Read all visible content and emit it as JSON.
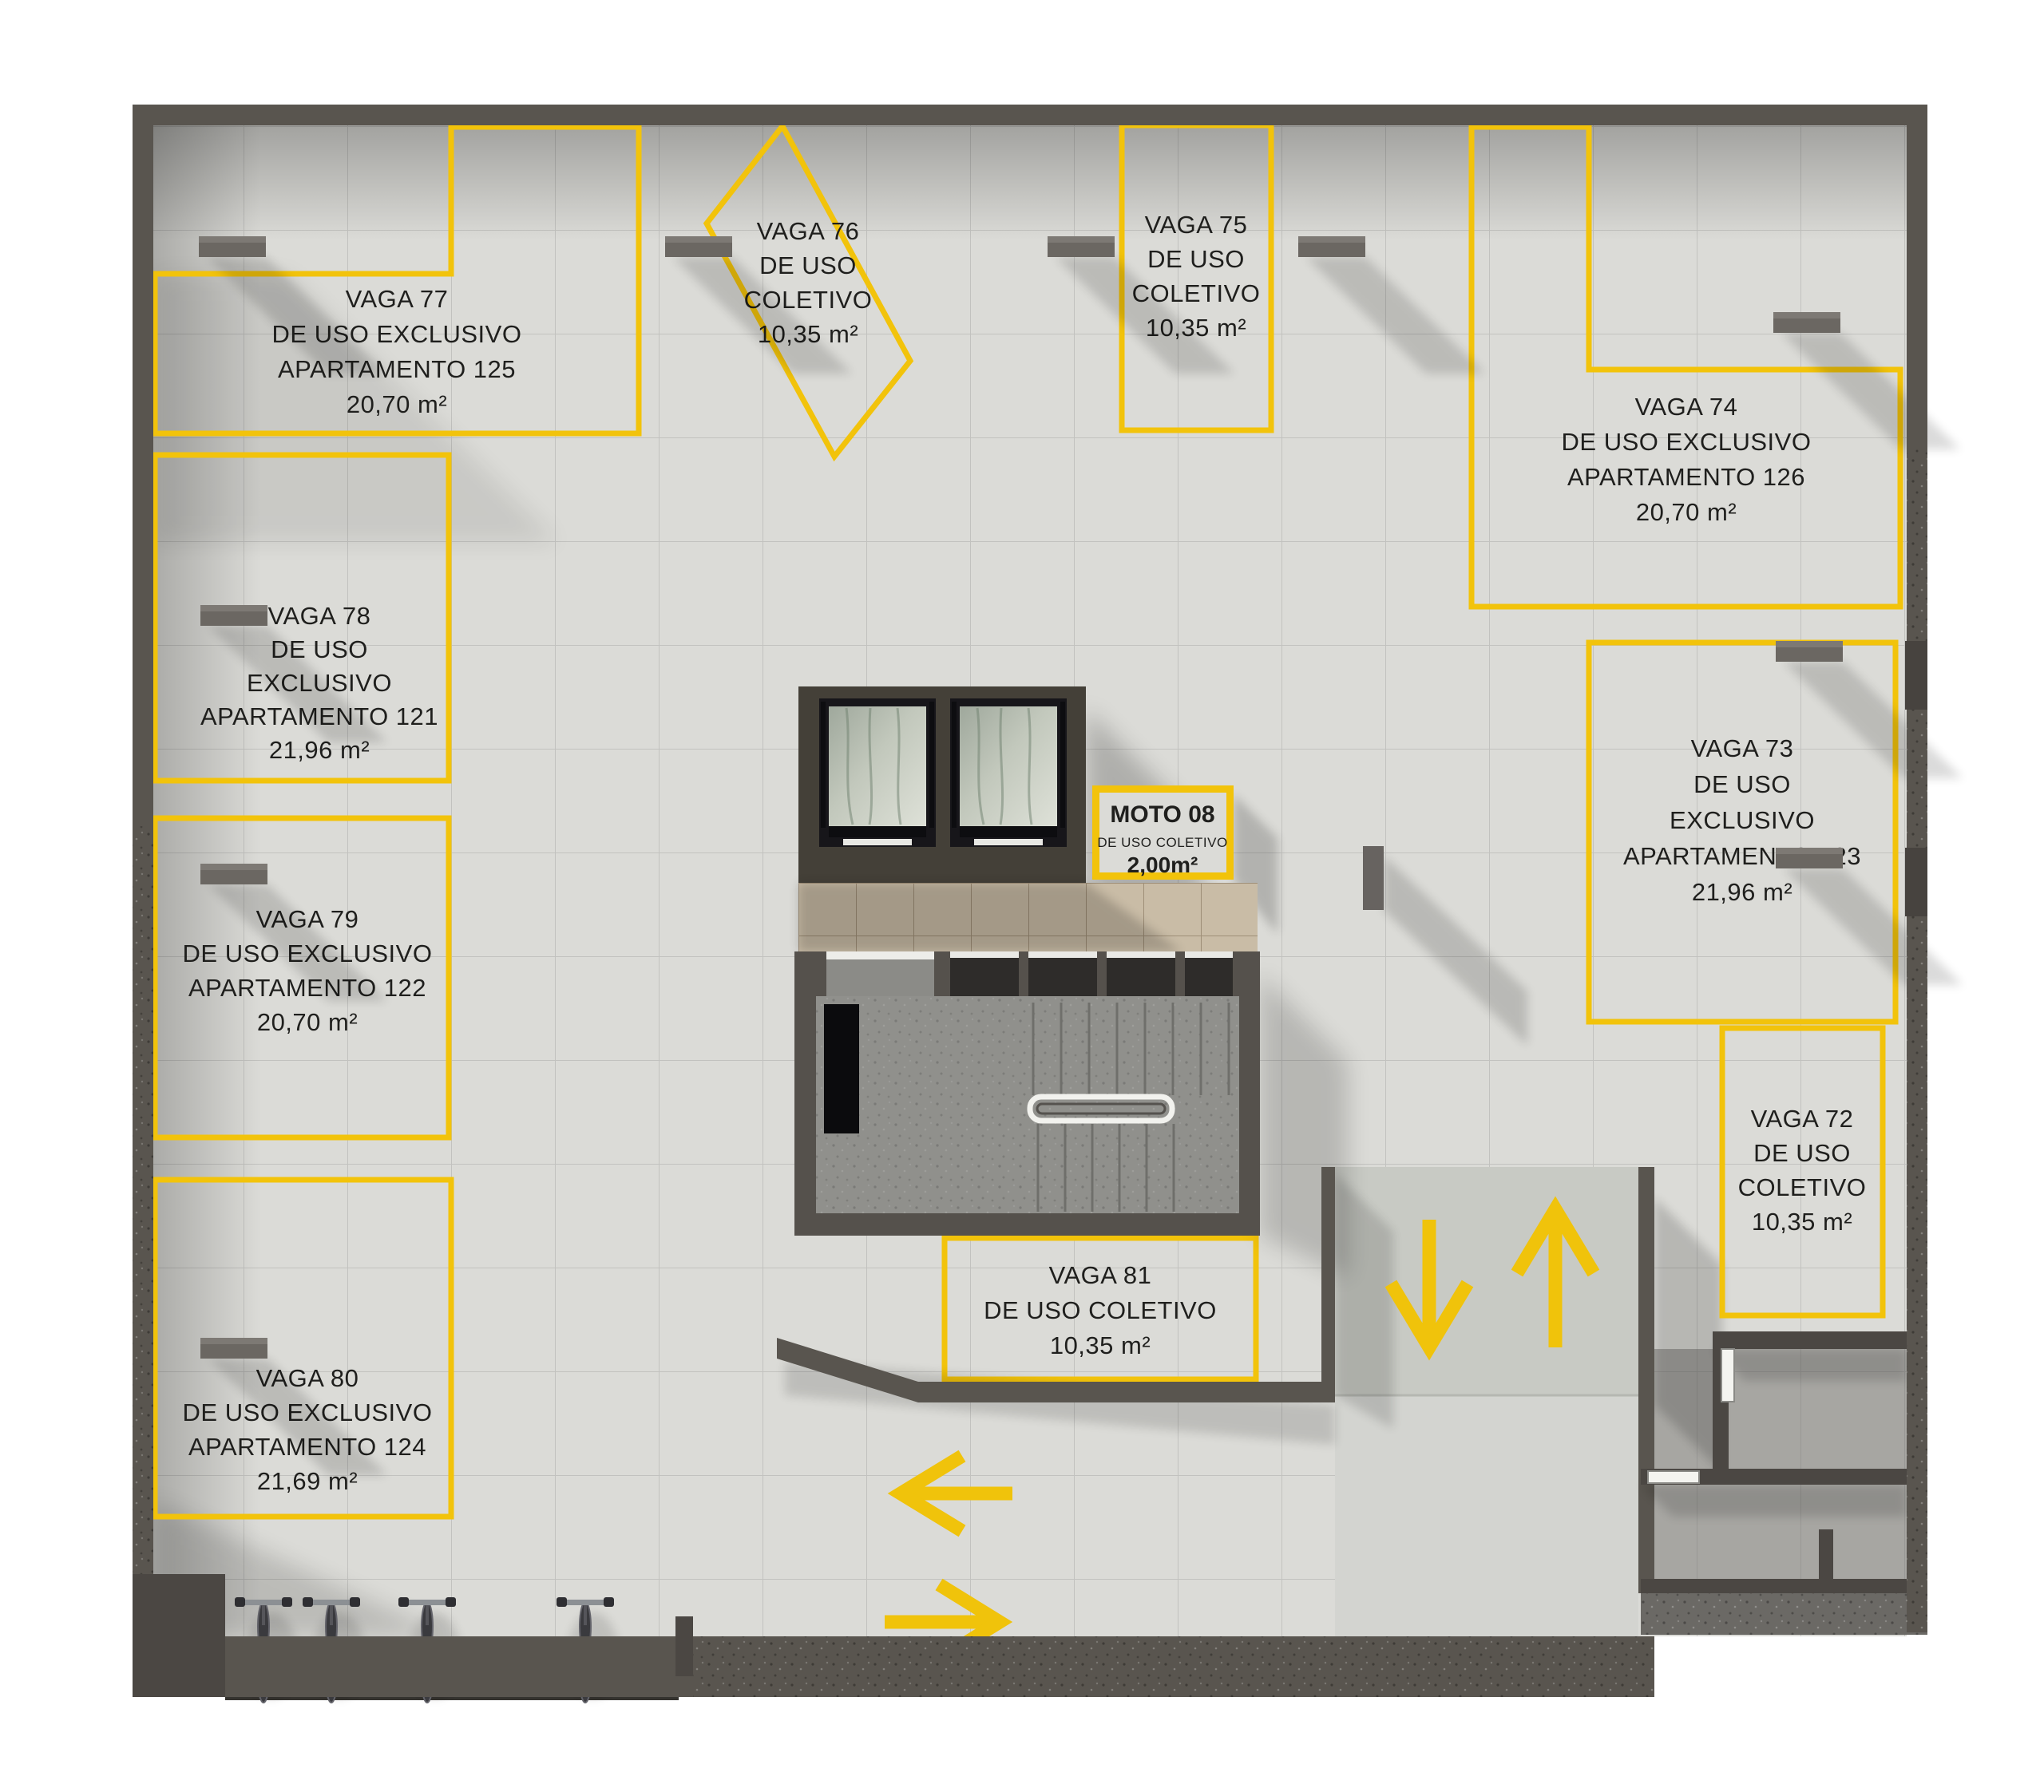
{
  "plan": {
    "type": "parking-garage-floor-plan",
    "spaces": [
      {
        "id": "vaga-77",
        "lines": [
          "VAGA 77",
          "DE USO EXCLUSIVO",
          "APARTAMENTO 125",
          "20,70 m²"
        ]
      },
      {
        "id": "vaga-76",
        "lines": [
          "VAGA 76",
          "DE USO",
          "COLETIVO",
          "10,35 m²"
        ]
      },
      {
        "id": "vaga-75",
        "lines": [
          "VAGA 75",
          "DE USO",
          "COLETIVO",
          "10,35 m²"
        ]
      },
      {
        "id": "vaga-74",
        "lines": [
          "VAGA 74",
          "DE USO EXCLUSIVO",
          "APARTAMENTO 126",
          "20,70 m²"
        ]
      },
      {
        "id": "vaga-78",
        "lines": [
          "VAGA 78",
          "DE USO",
          "EXCLUSIVO",
          "APARTAMENTO 121",
          "21,96 m²"
        ]
      },
      {
        "id": "vaga-73",
        "lines": [
          "VAGA 73",
          "DE USO",
          "EXCLUSIVO",
          "APARTAMENTO 123",
          "21,96 m²"
        ]
      },
      {
        "id": "vaga-79",
        "lines": [
          "VAGA 79",
          "DE USO EXCLUSIVO",
          "APARTAMENTO 122",
          "20,70 m²"
        ]
      },
      {
        "id": "vaga-80",
        "lines": [
          "VAGA 80",
          "DE USO EXCLUSIVO",
          "APARTAMENTO 124",
          "21,69 m²"
        ]
      },
      {
        "id": "vaga-81",
        "lines": [
          "VAGA 81",
          "DE USO COLETIVO",
          "10,35 m²"
        ]
      },
      {
        "id": "vaga-72",
        "lines": [
          "VAGA 72",
          "DE USO",
          "COLETIVO",
          "10,35 m²"
        ]
      }
    ],
    "moto_sign": {
      "lines": [
        "MOTO 08",
        "DE USO COLETIVO",
        "2,00m²"
      ]
    },
    "palette": {
      "accent_yellow": "#F2C30B",
      "wall_dark": "#59554F",
      "floor_light": "#DBDBD7",
      "room_floor_dark": "#A7A6A2",
      "lobby_beige": "#C9BCA6",
      "stair_floor": "#90908C",
      "marble_green": "#B9BFB3",
      "sign_background": "#DBDBD7",
      "label_ink": "#1F1F1D"
    }
  }
}
